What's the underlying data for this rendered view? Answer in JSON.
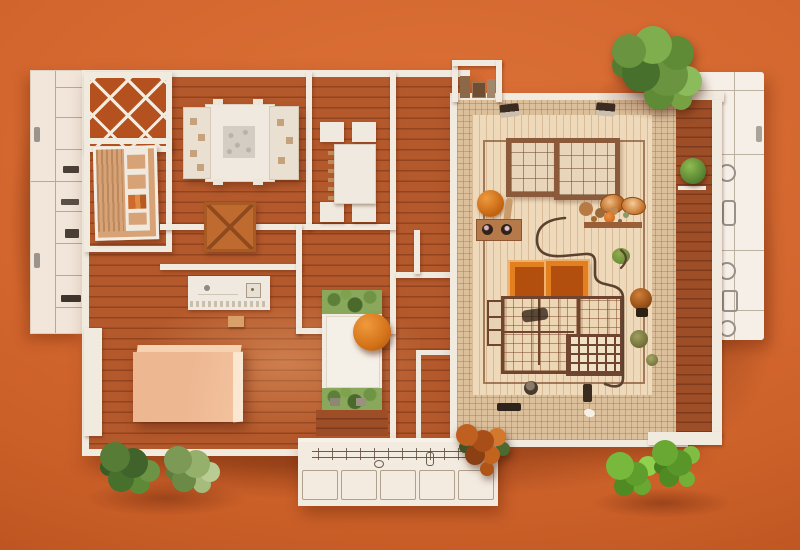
{
  "scene": {
    "description": "Top-down photograph of a miniature architectural floor-plan model mounted on a bright orange wall, furnished with tiny model furniture, sketch-drawn elevation panels and live green plants",
    "style": "physical scale model diorama, flat-lay lighting",
    "background_wall": "bright terracotta orange"
  },
  "palette": {
    "bg_orange": "#d2662e",
    "bg_orange_light": "#dd7238",
    "bg_orange_dark": "#c05620",
    "wall_white": "#f1eadf",
    "floor_terracotta": "#b4592c",
    "floor_line": "#93441f",
    "floor_dark": "#9d4e26",
    "lattice_orange": "#b4511f",
    "tile_border": "#dcc09c",
    "tile_floor": "#eedabb",
    "frame_brown": "#8a5a3a",
    "peach_sofa": "#f0bd97",
    "wardrobe_tan": "#d7a376",
    "xtable_tan": "#bf6b2f",
    "chair_orange": "#e2801f",
    "chair_inner": "#b34f0e",
    "wire_brown": "#5c4130",
    "plant_green": "#5f8a36",
    "plant_rust": "#bb5d1e",
    "sketch_line": "#6b5d4e"
  },
  "rooms": [
    {
      "name": "lattice-skylight-room",
      "floor": "dark orange with white diamond lattice"
    },
    {
      "name": "closet-room",
      "floor": "terracotta planks"
    },
    {
      "name": "bedroom",
      "floor": "terracotta planks"
    },
    {
      "name": "dining-room",
      "floor": "terracotta planks"
    },
    {
      "name": "kitchen-nook",
      "floor": "terracotta planks"
    },
    {
      "name": "living-room",
      "floor": "terracotta planks"
    },
    {
      "name": "courtyard-great-room",
      "floor": "beige mosaic tile with plaid rug panels"
    },
    {
      "name": "side-porch",
      "floor": "dark terracotta planks"
    },
    {
      "name": "left-utility-wing",
      "finish": "white panel with sketched shelving"
    },
    {
      "name": "right-elevation-panel",
      "finish": "white panel with sketched plumbing fixtures"
    },
    {
      "name": "bottom-cabinet-panel",
      "finish": "white panel with sketched cabinetry"
    }
  ],
  "furniture": [
    "double-bed-with-carved-headboards",
    "dining-table-with-four-chairs",
    "pitched-roof-side-table",
    "wardrobe-shelf-unit",
    "kitchen-counter-with-sink",
    "peach-sofa-block",
    "daybed-with-planter-ends",
    "round-orange-tree",
    "two-orange-lounge-chairs",
    "plaid-rug-grid-panels",
    "two-wall-lamps",
    "two-grid-windows",
    "display-shelves-with-pots",
    "shell-bowls",
    "bent-wire-sculpture",
    "floor-window-frame",
    "top-niche-with-miniatures"
  ],
  "plants": [
    "large-fern-top-right",
    "porch-shelf-plant",
    "courtyard-orange-pompom",
    "dried-flower-shelf",
    "rust-bouquet-bottom-center",
    "bush-bottom-left-1",
    "bush-bottom-left-2",
    "grass-bottom-right-1",
    "grass-bottom-right-2",
    "courtyard-rust-shrub",
    "courtyard-olive-tufts"
  ]
}
